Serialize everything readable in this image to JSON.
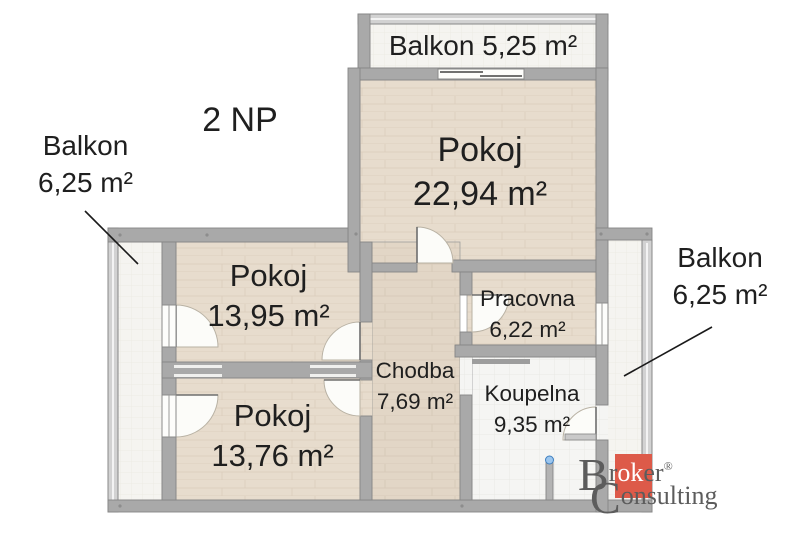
{
  "floor_title": "2 NP",
  "balconies": {
    "top": {
      "label": "Balkon 5,25 m²"
    },
    "left": {
      "name": "Balkon",
      "area": "6,25 m²"
    },
    "right": {
      "name": "Balkon",
      "area": "6,25 m²"
    }
  },
  "rooms": {
    "pokoj_large": {
      "name": "Pokoj",
      "area": "22,94 m²"
    },
    "pokoj_upper_left": {
      "name": "Pokoj",
      "area": "13,95 m²"
    },
    "pokoj_lower_left": {
      "name": "Pokoj",
      "area": "13,76 m²"
    },
    "pracovna": {
      "name": "Pracovna",
      "area": "6,22 m²"
    },
    "chodba": {
      "name": "Chodba",
      "area": "7,69 m²"
    },
    "koupelna": {
      "name": "Koupelna",
      "area": "9,35 m²"
    }
  },
  "logo": {
    "line1_initial": "B",
    "line1_pre": "r",
    "line1_highlight": "ok",
    "line1_post": "er",
    "registered": "®",
    "line2_initial": "C",
    "line2_rest": "onsulting"
  },
  "colors": {
    "wall": "#a9a9a9",
    "wood_floor": "#e7dccd",
    "tile_floor": "#f5f5f3",
    "balcony_floor": "#f5f4f0",
    "logo_orange": "#dd5a49",
    "label_text": "#1f1f1f",
    "logo_text": "#5c5c5c"
  }
}
